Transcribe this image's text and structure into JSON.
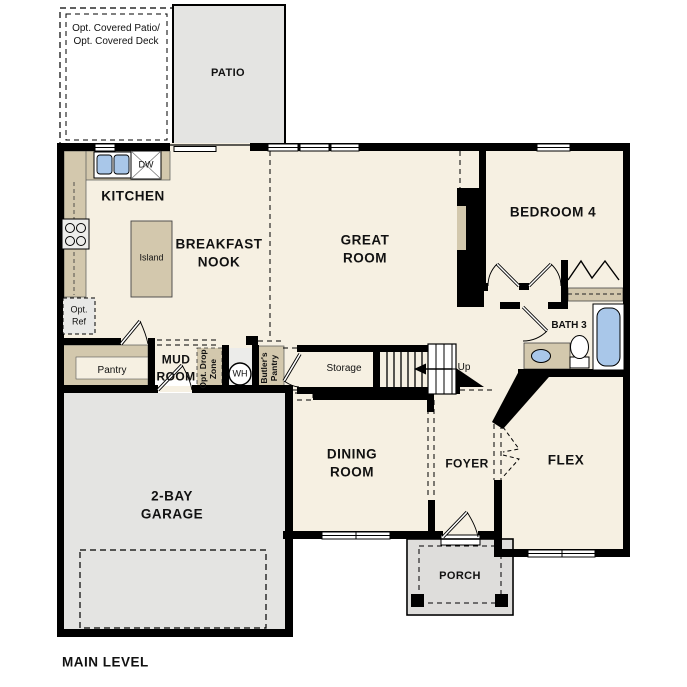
{
  "title": "MAIN LEVEL",
  "labels": {
    "optPatio1": "Opt. Covered Patio/",
    "optPatio2": "Opt. Covered Deck",
    "patio": "PATIO",
    "kitchen": "KITCHEN",
    "dw": "DW",
    "island": "Island",
    "nook1": "BREAKFAST",
    "nook2": "NOOK",
    "great1": "GREAT",
    "great2": "ROOM",
    "bedroom4": "BEDROOM 4",
    "optRef1": "Opt.",
    "optRef2": "Ref",
    "pantry": "Pantry",
    "mud1": "MUD",
    "mud2": "ROOM",
    "drop1": "Opt. Drop",
    "drop2": "Zone",
    "wh": "WH",
    "butler1": "Butler's",
    "butler2": "Pantry",
    "storage": "Storage",
    "up": "Up",
    "bath3": "BATH 3",
    "dining1": "DINING",
    "dining2": "ROOM",
    "foyer": "FOYER",
    "flex": "FLEX",
    "porch": "PORCH",
    "garage1": "2-BAY",
    "garage2": "GARAGE",
    "mainLevel": "MAIN LEVEL"
  },
  "colors": {
    "floor": "#f6f0e2",
    "counter": "#d3c8ad",
    "gray": "#e4e4e2",
    "grayDark": "#dedddb",
    "fixtureBlue": "#a9c7e9",
    "appliance": "#ededeb",
    "refGray": "#e8e8e6",
    "wall": "#000000"
  }
}
